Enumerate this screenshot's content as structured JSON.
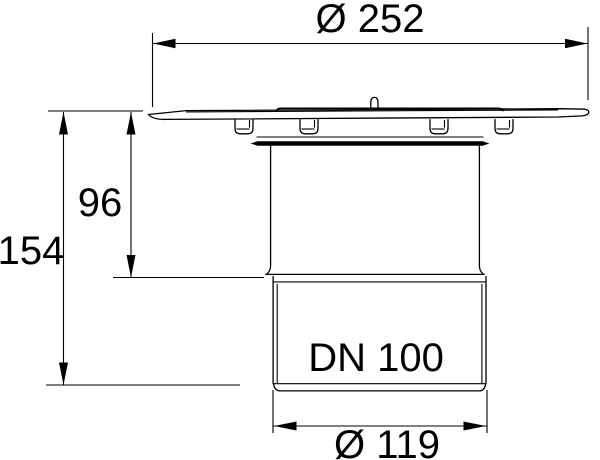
{
  "page": {
    "background": "#ffffff",
    "width": 600,
    "height": 460
  },
  "drawing": {
    "line_color": "#000000",
    "labels": {
      "dia_top": "Ø 252",
      "height_upper": "96",
      "height_total": "154",
      "nominal_width": "DN 100",
      "dia_bottom": "Ø 119"
    },
    "dimensions_mm": {
      "flange_diameter": 252,
      "upper_height": 96,
      "total_height": 154,
      "outlet_diameter": 119,
      "nominal_size": "DN 100"
    }
  }
}
